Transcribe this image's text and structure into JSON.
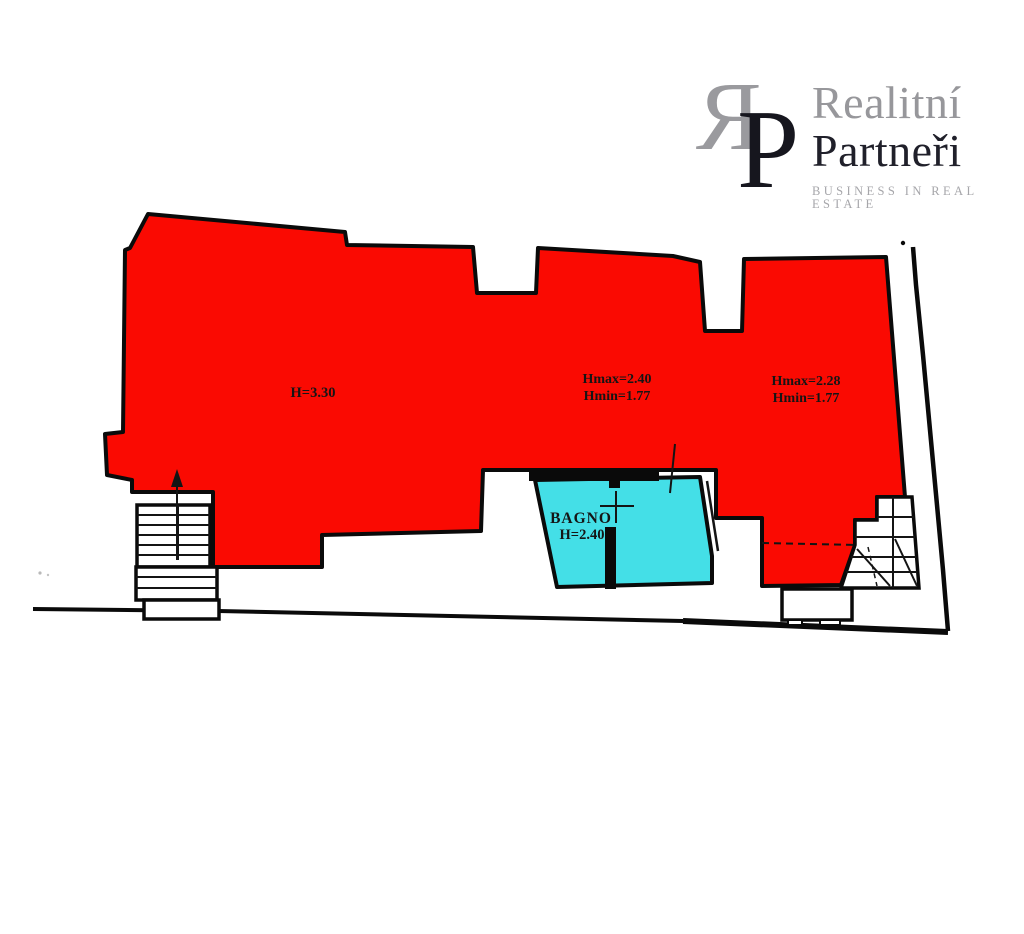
{
  "page": {
    "background": "#ffffff"
  },
  "logo": {
    "monogram_r": "R",
    "monogram_p": "P",
    "name_line1": "Realitní",
    "name_line2": "Partneři",
    "tagline": "BUSINESS IN REAL ESTATE",
    "colors": {
      "gray": "#97979b",
      "dark": "#1d1d28",
      "tagline_gray": "#a6a6aa"
    }
  },
  "floorplan": {
    "colors": {
      "red": "#fa0a02",
      "cyan": "#44dfe7",
      "wall": "#0a0a0a",
      "label_text": "#151515"
    },
    "labels": {
      "left_room": {
        "line1": "H=3.30"
      },
      "middle_room": {
        "line1": "Hmax=2.40",
        "line2": "Hmin=1.77"
      },
      "right_room": {
        "line1": "Hmax=2.28",
        "line2": "Hmin=1.77"
      },
      "bathroom": {
        "line1": "BAGNO",
        "line2": "H=2.40"
      }
    },
    "marks": {
      "stair_direction": "up"
    }
  }
}
